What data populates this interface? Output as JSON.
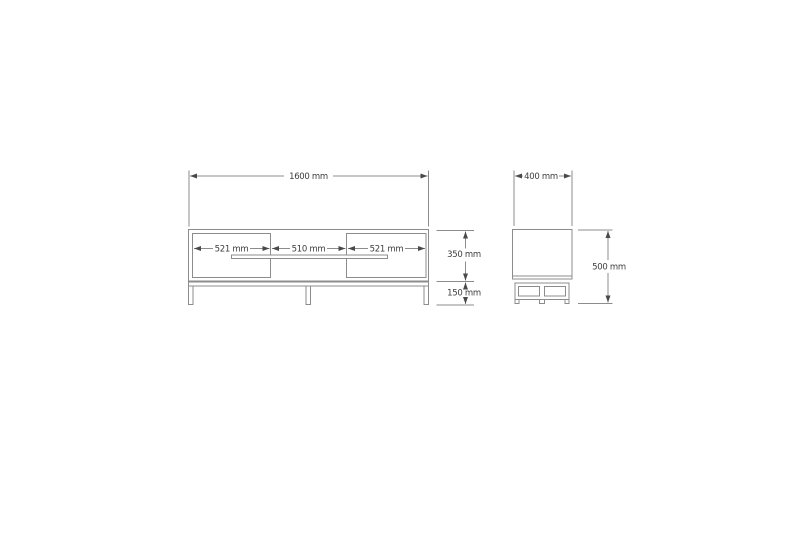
{
  "drawing": {
    "description": "TV stand technical drawing, front and side orthographic views with dimensions",
    "colors": {
      "line": "#8c8c8c",
      "dim": "#8c8c8c",
      "arrow": "#4a4a4a",
      "text": "#3c3c3c"
    },
    "front_view": {
      "overall_width": "1600 mm",
      "left_door_width": "521 mm",
      "middle_width": "510 mm",
      "right_door_width": "521 mm",
      "body_height": "350 mm",
      "leg_height": "150 mm"
    },
    "side_view": {
      "depth": "400 mm",
      "overall_height": "500 mm"
    }
  }
}
